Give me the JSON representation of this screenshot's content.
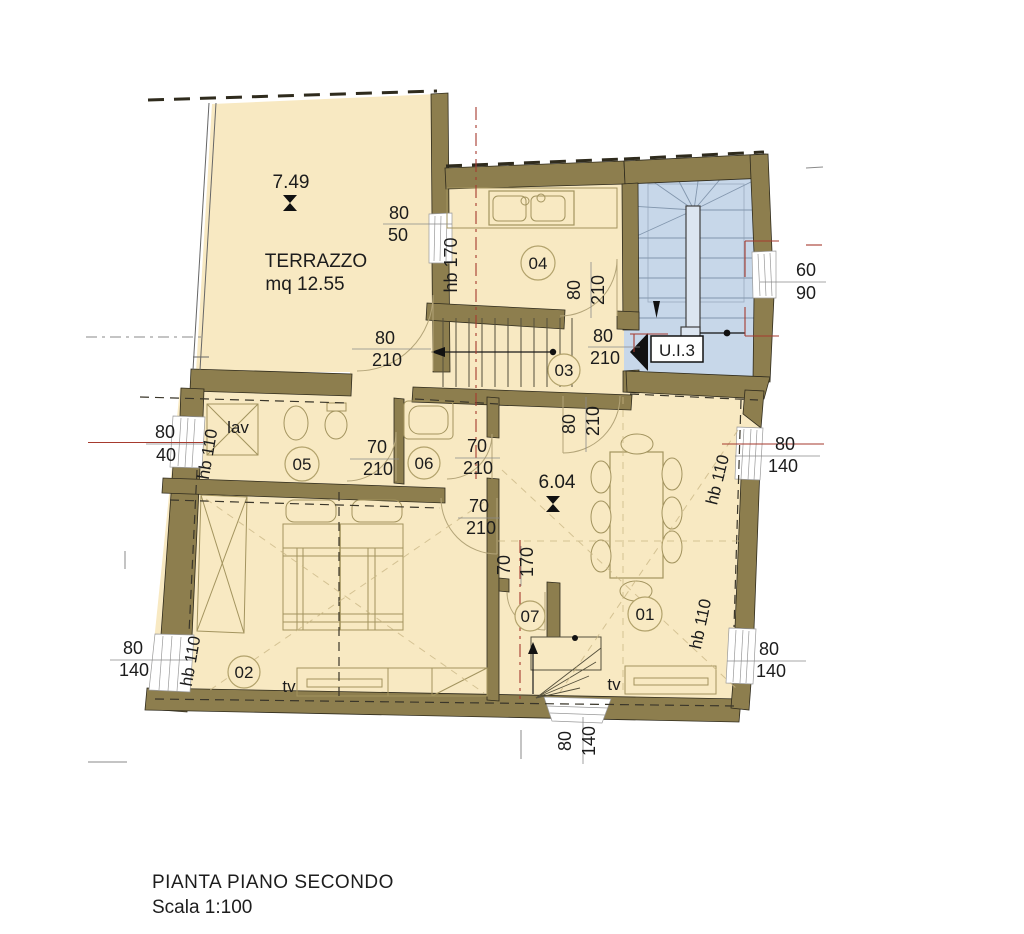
{
  "title_block": {
    "line1": "PIANTA PIANO SECONDO",
    "line2": "Scala 1:100"
  },
  "plan": {
    "unit_label": "U.I.3",
    "terrace": {
      "height_marker": "7.49",
      "name": "TERRAZZO",
      "area": "mq 12.55"
    },
    "main_height_marker": "6.04",
    "rooms": [
      {
        "n": "01",
        "cx": 645,
        "cy": 614,
        "r": 17
      },
      {
        "n": "02",
        "cx": 244,
        "cy": 672,
        "r": 16
      },
      {
        "n": "03",
        "cx": 564,
        "cy": 370,
        "r": 16
      },
      {
        "n": "04",
        "cx": 538,
        "cy": 263,
        "r": 17
      },
      {
        "n": "05",
        "cx": 302,
        "cy": 464,
        "r": 17
      },
      {
        "n": "06",
        "cx": 424,
        "cy": 463,
        "r": 16
      },
      {
        "n": "07",
        "cx": 530,
        "cy": 616,
        "r": 15
      }
    ],
    "labels": [
      {
        "id": "terrace-height",
        "t": "7.49",
        "x": 291,
        "y": 188,
        "s": 19
      },
      {
        "id": "terrace-name",
        "t": "TERRAZZO",
        "x": 316,
        "y": 267,
        "s": 19
      },
      {
        "id": "terrace-area",
        "t": "mq 12.55",
        "x": 305,
        "y": 290,
        "s": 19
      },
      {
        "id": "win-80-50-a",
        "t": "80",
        "x": 399,
        "y": 219,
        "s": 18
      },
      {
        "id": "win-80-50-b",
        "t": "50",
        "x": 398,
        "y": 241,
        "s": 18
      },
      {
        "id": "hb-170",
        "t": "hb 170",
        "x": 457,
        "y": 265,
        "s": 18,
        "rot": -90
      },
      {
        "id": "door-terrace-a",
        "t": "80",
        "x": 385,
        "y": 344,
        "s": 18
      },
      {
        "id": "door-terrace-b",
        "t": "210",
        "x": 387,
        "y": 366,
        "s": 18
      },
      {
        "id": "door-kitchen-a",
        "t": "80",
        "x": 580,
        "y": 290,
        "s": 18,
        "rot": -90
      },
      {
        "id": "door-kitchen-b",
        "t": "210",
        "x": 604,
        "y": 290,
        "s": 18,
        "rot": -90
      },
      {
        "id": "door-ui3-a",
        "t": "80",
        "x": 603,
        "y": 342,
        "s": 18
      },
      {
        "id": "door-ui3-b",
        "t": "210",
        "x": 605,
        "y": 364,
        "s": 18
      },
      {
        "id": "ui3-label",
        "t": "U.I.3",
        "x": 677,
        "y": 356,
        "s": 17
      },
      {
        "id": "win-60-90-a",
        "t": "60",
        "x": 806,
        "y": 276,
        "s": 18
      },
      {
        "id": "win-60-90-b",
        "t": "90",
        "x": 806,
        "y": 299,
        "s": 18
      },
      {
        "id": "win-80-40-a",
        "t": "80",
        "x": 165,
        "y": 438,
        "s": 18
      },
      {
        "id": "win-80-40-b",
        "t": "40",
        "x": 166,
        "y": 461,
        "s": 18
      },
      {
        "id": "lav-label",
        "t": "lav",
        "x": 238,
        "y": 433,
        "s": 17
      },
      {
        "id": "hb-110-bath",
        "t": "hb 110",
        "x": 213,
        "y": 455,
        "s": 17,
        "rot": -80
      },
      {
        "id": "door-05-a",
        "t": "70",
        "x": 377,
        "y": 453,
        "s": 18
      },
      {
        "id": "door-05-b",
        "t": "210",
        "x": 378,
        "y": 475,
        "s": 18
      },
      {
        "id": "door-06-a",
        "t": "70",
        "x": 477,
        "y": 452,
        "s": 18
      },
      {
        "id": "door-06-b",
        "t": "210",
        "x": 478,
        "y": 474,
        "s": 18
      },
      {
        "id": "door-02-a",
        "t": "70",
        "x": 479,
        "y": 512,
        "s": 18
      },
      {
        "id": "door-02-b",
        "t": "210",
        "x": 481,
        "y": 534,
        "s": 18
      },
      {
        "id": "door-living-a",
        "t": "80",
        "x": 575,
        "y": 424,
        "s": 18,
        "rot": -90
      },
      {
        "id": "door-living-b",
        "t": "210",
        "x": 599,
        "y": 421,
        "s": 18,
        "rot": -90
      },
      {
        "id": "main-height",
        "t": "6.04",
        "x": 557,
        "y": 488,
        "s": 19
      },
      {
        "id": "hb-110-dining",
        "t": "hb 110",
        "x": 723,
        "y": 481,
        "s": 17,
        "rot": -76
      },
      {
        "id": "win-right1-a",
        "t": "80",
        "x": 785,
        "y": 450,
        "s": 18
      },
      {
        "id": "win-right1-b",
        "t": "140",
        "x": 783,
        "y": 472,
        "s": 18
      },
      {
        "id": "pass-07-a",
        "t": "70",
        "x": 510,
        "y": 565,
        "s": 18,
        "rot": -90
      },
      {
        "id": "pass-07-b",
        "t": "170",
        "x": 533,
        "y": 562,
        "s": 18,
        "rot": -90
      },
      {
        "id": "hb-110-living",
        "t": "hb 110",
        "x": 706,
        "y": 625,
        "s": 17,
        "rot": -78
      },
      {
        "id": "win-right2-a",
        "t": "80",
        "x": 769,
        "y": 655,
        "s": 18
      },
      {
        "id": "win-right2-b",
        "t": "140",
        "x": 771,
        "y": 677,
        "s": 18
      },
      {
        "id": "tv-01",
        "t": "tv",
        "x": 614,
        "y": 690,
        "s": 17
      },
      {
        "id": "hb-110-bed",
        "t": "hb 110",
        "x": 196,
        "y": 662,
        "s": 17,
        "rot": -80
      },
      {
        "id": "win-left2-a",
        "t": "80",
        "x": 133,
        "y": 654,
        "s": 18
      },
      {
        "id": "win-left2-b",
        "t": "140",
        "x": 134,
        "y": 676,
        "s": 18
      },
      {
        "id": "tv-02",
        "t": "tv",
        "x": 289,
        "y": 692,
        "s": 17
      },
      {
        "id": "win-bottom-a",
        "t": "80",
        "x": 571,
        "y": 741,
        "s": 18,
        "rot": -90
      },
      {
        "id": "win-bottom-b",
        "t": "140",
        "x": 595,
        "y": 741,
        "s": 18,
        "rot": -90
      }
    ],
    "colors": {
      "wall": "#8d7e4e",
      "floor": "#f8e9c2",
      "stairwell": "#c7d7e9",
      "section_red": "#a63a2e",
      "line": "#2f2b1d"
    }
  }
}
